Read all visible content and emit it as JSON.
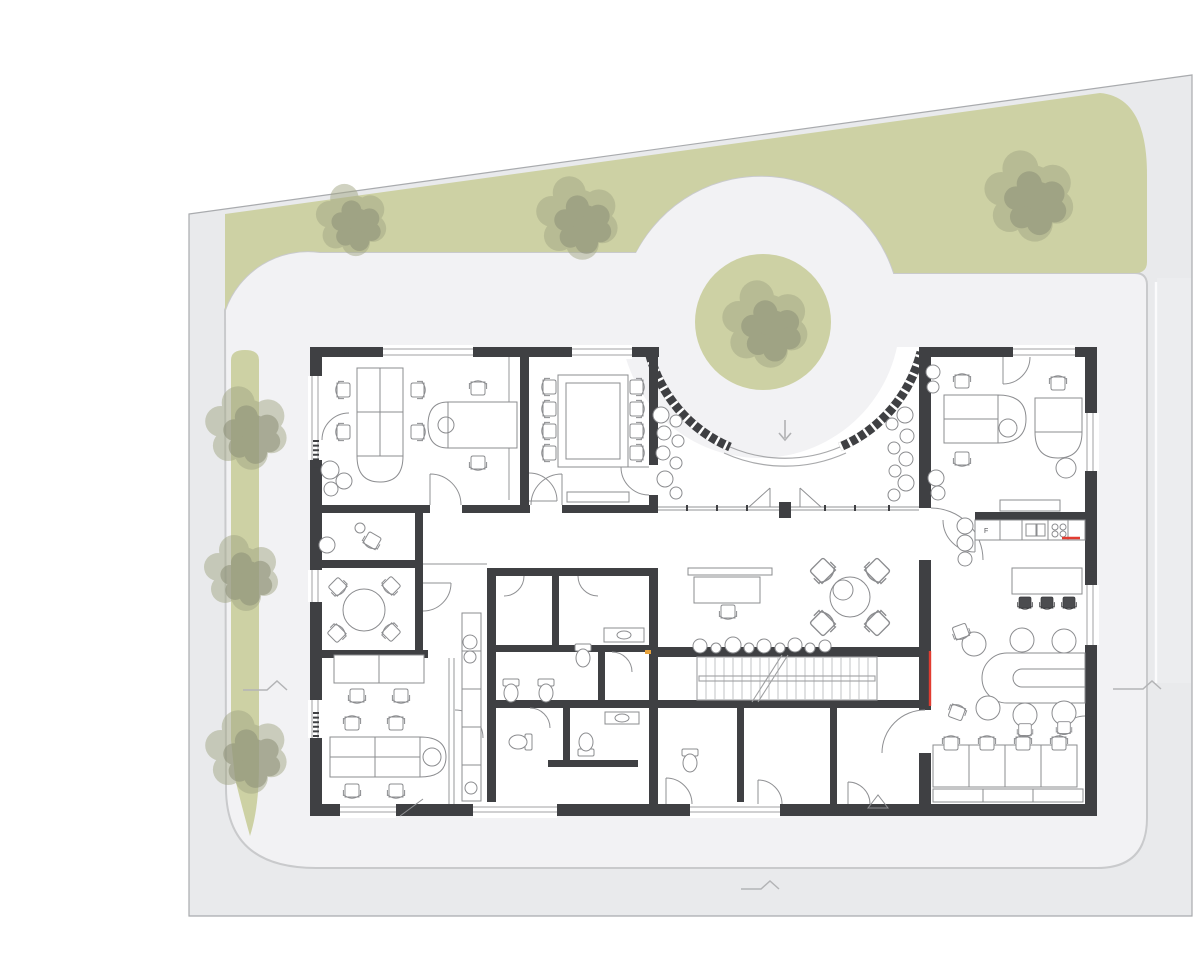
{
  "document": {
    "description": "Architectural ground-floor site plan: office building drawn top-down with dark walls and line furniture, surrounded by a grey plot with olive-green planting bands, seven scalloped trees, a circular green island inside a curved glazed entrance rotunda, internal stair, WC core, kitchen and lounge",
    "visible_text": [
      "F"
    ]
  },
  "colors": {
    "page_background": "#ffffff",
    "site_fill": "#e9eaec",
    "site_border": "#a9abae",
    "margin_fill": "#ecedef",
    "court_fill": "#f2f2f4",
    "path_line": "#c9cacc",
    "green_fill": "#cdd1a4",
    "tree_light": "#a3a785",
    "tree_dark": "#8d9077",
    "wall_fill": "#3f4043",
    "glass_line": "#a8a9ab",
    "furniture_line": "#8b8c8f",
    "stair_line": "#c2c3c5",
    "accent_red": "#e23c31",
    "accent_orange": "#e8a33d",
    "marker_line": "#b3b4b6",
    "entry_arrow": "#b0b1b3"
  },
  "kitchen": {
    "fridge_label": "F"
  },
  "depicted": {
    "trees": 7,
    "conference_chairs": 8,
    "open_office_chairs": 12,
    "lounge_pouf_seats": 6,
    "study_carrels": 4,
    "kitchen_island_stools": 3,
    "toilets": 6,
    "stair_flights": 1,
    "site_markers": 3,
    "entrance": "curved glazed rotunda wall with double swing doors and green tree island"
  }
}
